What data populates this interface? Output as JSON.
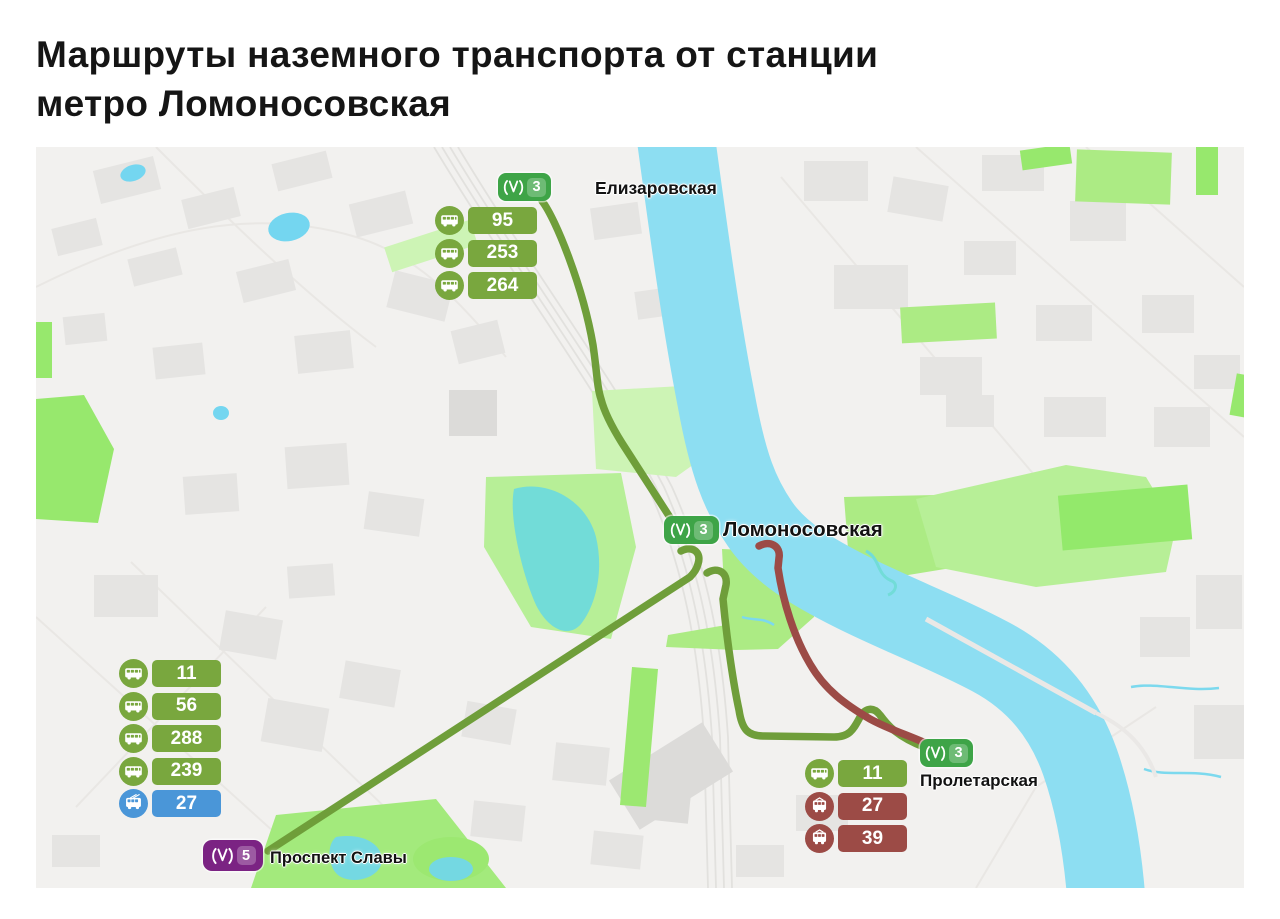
{
  "title": {
    "line1": "Маршруты наземного транспорта от станции",
    "line2": "метро Ломоносовская"
  },
  "stations": {
    "elizarovskaya": {
      "name": "Елизаровская",
      "line": "3",
      "line_color": "#3ea447"
    },
    "lomonosovskaya": {
      "name": "Ломоносовская",
      "line": "3",
      "line_color": "#3ea447"
    },
    "proletarskaya": {
      "name": "Пролетарская",
      "line": "3",
      "line_color": "#3ea447"
    },
    "prospekt_slavy": {
      "name": "Проспект Славы",
      "line": "5",
      "line_color": "#7b2383"
    }
  },
  "route_groups": {
    "elizarovskaya": {
      "routes": [
        {
          "type": "bus",
          "number": "95"
        },
        {
          "type": "bus",
          "number": "253"
        },
        {
          "type": "bus",
          "number": "264"
        }
      ]
    },
    "prospekt_slavy": {
      "routes": [
        {
          "type": "bus",
          "number": "11"
        },
        {
          "type": "bus",
          "number": "56"
        },
        {
          "type": "bus",
          "number": "288"
        },
        {
          "type": "bus",
          "number": "239"
        },
        {
          "type": "trolleybus",
          "number": "27"
        }
      ]
    },
    "proletarskaya": {
      "routes": [
        {
          "type": "bus",
          "number": "11"
        },
        {
          "type": "tram",
          "number": "27"
        },
        {
          "type": "tram",
          "number": "39"
        }
      ]
    }
  },
  "colors": {
    "bus_badge_green": "#79a73e",
    "route_line_green": "#6f9e3a",
    "tram_red": "#9c4b46",
    "trolleybus_blue": "#4a96d8",
    "metro_line3_green": "#3ea447",
    "metro_line5_purple": "#7b2383",
    "river_blue": "#8ddef2",
    "lake_teal": "#72dcd8",
    "park_green": "#97e86d"
  }
}
